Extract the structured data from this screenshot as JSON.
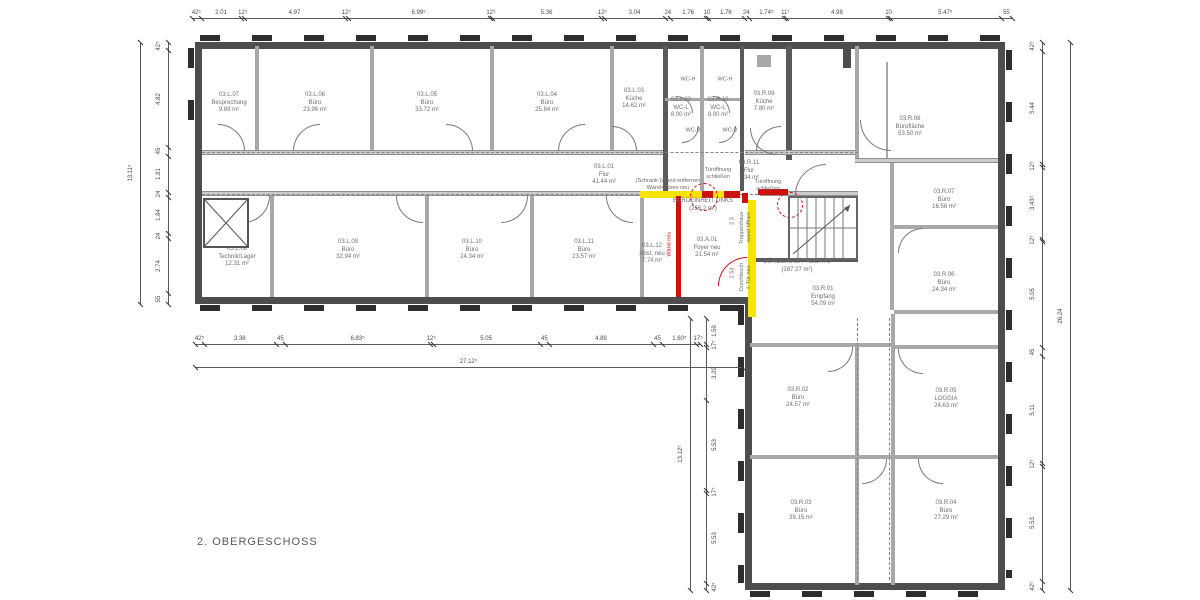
{
  "drawing": {
    "floor_label": "2. OBERGESCHOSS"
  },
  "units": {
    "left": {
      "name": "BÜROEINHEIT LINKS",
      "area": "(256.2 m²)"
    },
    "right": {
      "name": "BÜROEINHEIT RECHTS",
      "area": "(287.27 m²)"
    }
  },
  "rooms": [
    {
      "id": "03.L.07",
      "name": "Besprechung",
      "area": "9.69 m²"
    },
    {
      "id": "03.L.06",
      "name": "Büro",
      "area": "23.96 m²"
    },
    {
      "id": "03.L.05",
      "name": "Büro",
      "area": "33.72 m²"
    },
    {
      "id": "03.L.04",
      "name": "Büro",
      "area": "25.84 m²"
    },
    {
      "id": "03.L.03",
      "name": "Küche",
      "area": "14.62 m²"
    },
    {
      "id": "03.L.02",
      "name": "WC-L",
      "area": "8.00 m²"
    },
    {
      "id": "03.R.10",
      "name": "WC-L",
      "area": "8.00 m²"
    },
    {
      "id": "03.R.09",
      "name": "Küche",
      "area": "7.80 m²"
    },
    {
      "id": "03.R.08",
      "name": "Bürofläche",
      "area": "53.50 m²"
    },
    {
      "id": "03.L.01",
      "name": "Flur",
      "area": "41.44 m²"
    },
    {
      "id": "03.R.11",
      "name": "Flur",
      "area": "7.34 m²"
    },
    {
      "id": "03.L.08",
      "name": "Technik/Lager",
      "area": "12.31 m²"
    },
    {
      "id": "03.L.09",
      "name": "Büro",
      "area": "32.94 m²"
    },
    {
      "id": "03.L.10",
      "name": "Büro",
      "area": "24.34 m²"
    },
    {
      "id": "03.L.11",
      "name": "Büro",
      "area": "23.57 m²"
    },
    {
      "id": "03.L.12",
      "name": "Abst. neu",
      "area": "7.74 m²"
    },
    {
      "id": "03.A.01",
      "name": "Foyer neu",
      "area": "21.54 m²"
    },
    {
      "id": "03.R.07",
      "name": "Büro",
      "area": "16.56 m²"
    },
    {
      "id": "03.R.06",
      "name": "Büro",
      "area": "24.34 m²"
    },
    {
      "id": "03.R.01",
      "name": "Empfang",
      "area": "54.09 m²"
    },
    {
      "id": "03.R.02",
      "name": "Büro",
      "area": "24.57 m²"
    },
    {
      "id": "03.R.05",
      "name": "LOGGIA",
      "area": "24.63 m²"
    },
    {
      "id": "03.R.03",
      "name": "Büro",
      "area": "39.15 m²"
    },
    {
      "id": "03.R.04",
      "name": "Büro",
      "area": "27.29 m²"
    }
  ],
  "wc_labels": [
    "WC-H",
    "WC-H",
    "WC-D",
    "WC-D"
  ],
  "annotations": {
    "remove_wall": "(Schrank-)Wand entfernen\nWand+Türen neu",
    "close_door_1": "Türöffnung\nschließen",
    "close_door_2": "Türöffnung\nschließen",
    "open_stair_wall": "Treppenhaus-\nwand öffnen",
    "breakthrough": "Durchbruch\nf. Tür neu",
    "new_wall": "Wand neu",
    "dim_a": "2.3",
    "dim_b": "2.53"
  },
  "dims": {
    "top": [
      "42⁵",
      "2.01",
      "12⁵",
      "4.97",
      "12⁵",
      "6.99⁵",
      "12⁵",
      "5.36",
      "12⁵",
      "3.04",
      "24",
      "1.76",
      "10",
      "1.76",
      "24",
      "1.74⁵",
      "11¹",
      "4.98",
      "10",
      "5.47⁵",
      "55"
    ],
    "left": [
      "42⁵",
      "4.82",
      "45",
      "1.81",
      "24",
      "1.84",
      "24",
      "2.74",
      "55"
    ],
    "left_overall": "13.11⁵",
    "bottom": [
      "42⁵",
      "3.38",
      "45",
      "6.83⁵",
      "12⁵",
      "5.05",
      "45",
      "4.89",
      "45",
      "1.60⁵",
      "17⁵"
    ],
    "bottom_overall": "27.12⁵",
    "inner": [
      "1.59",
      "17⁵",
      "3.29",
      "5.53",
      "17⁵",
      "5.53",
      "42⁵"
    ],
    "inner_overall": "13.12⁵",
    "right": [
      "42⁵",
      "5.44",
      "12⁵",
      "3.43⁵",
      "12⁵",
      "5.05",
      "45",
      "5.11",
      "12⁵",
      "5.53",
      "42⁵"
    ],
    "right_overall": "26.24"
  },
  "colors": {
    "exterior_wall": "#4d4d4d",
    "interior_wall": "#a8a8a8",
    "highlight_yellow": "#f6e300",
    "highlight_red": "#cc1111",
    "text": "#6b6b6b"
  }
}
